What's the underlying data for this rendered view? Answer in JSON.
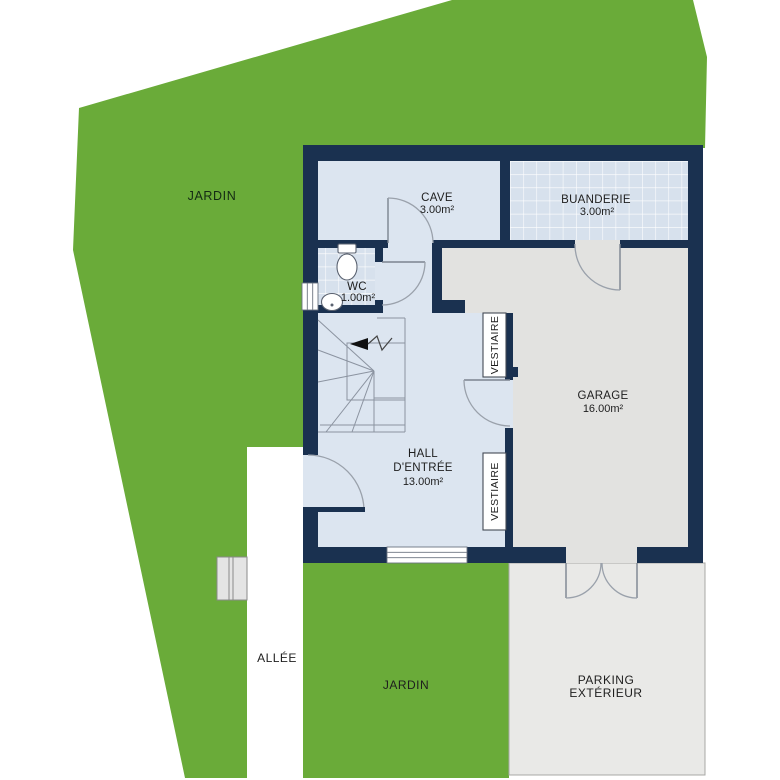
{
  "site": {
    "jardin_top": "JARDIN",
    "jardin_bottom": "JARDIN",
    "allee": "ALLÉE",
    "parking_line1": "PARKING",
    "parking_line2": "EXTÉRIEUR"
  },
  "rooms": {
    "cave_name": "CAVE",
    "cave_area": "3.00m²",
    "buanderie_name": "BUANDERIE",
    "buanderie_area": "3.00m²",
    "wc_name": "WC",
    "wc_area": "1.00m²",
    "garage_name": "GARAGE",
    "garage_area": "16.00m²",
    "hall_line1": "HALL",
    "hall_line2": "D'ENTRÉE",
    "hall_area": "13.00m²",
    "vestiaire_upper": "VESTIAIRE",
    "vestiaire_lower": "VESTIAIRE"
  },
  "colors": {
    "garden": "#6aab39",
    "wall": "#1a3150",
    "floor_hall": "#dce5f0",
    "floor_tile": "#d7e1ed",
    "floor_garage": "#e2e2e0",
    "floor_parking": "#e9e9e7",
    "alley": "#ffffff"
  }
}
